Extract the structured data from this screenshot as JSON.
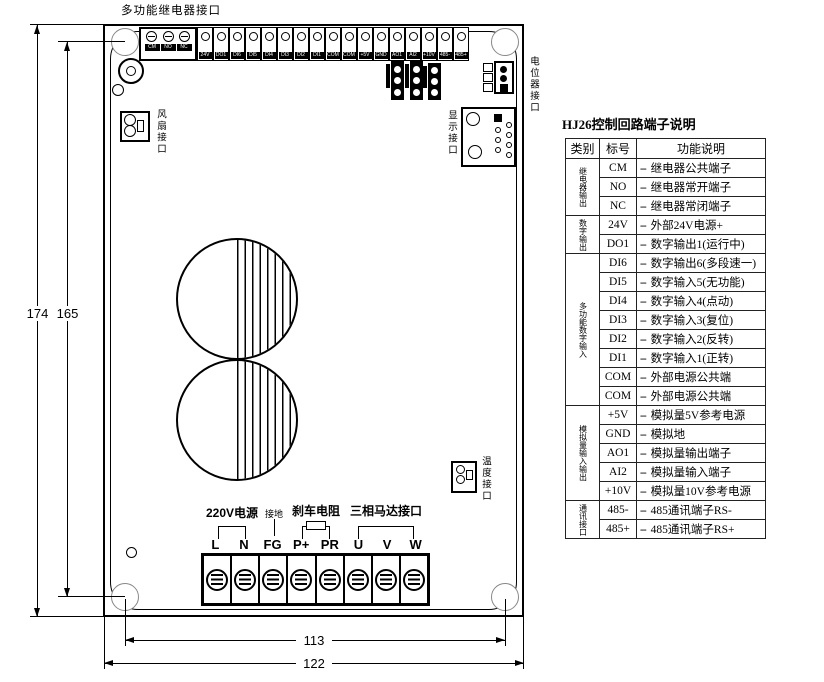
{
  "drawing": {
    "top_label": "多功能继电器接口",
    "relay_terminals": [
      "CM",
      "NO",
      "NC"
    ],
    "control_terminals": [
      "24V",
      "DO1",
      "DI6",
      "DI5",
      "DI4",
      "DI3",
      "DI2",
      "DI1",
      "COM",
      "COM",
      "+5V",
      "GND",
      "AO1",
      "AI2",
      "+10V",
      "485-",
      "485+"
    ],
    "fan_label": "风扇接口",
    "display_label": "显示接口",
    "pot_label": "电位器接口",
    "temp_label": "温度接口",
    "power_terminals": [
      "L",
      "N",
      "FG",
      "P+",
      "PR",
      "U",
      "V",
      "W"
    ],
    "group_220v": "220V电源",
    "group_ground": "接地",
    "group_brake": "刹车电阻",
    "group_motor": "三相马达接口",
    "dim_height_outer": "174",
    "dim_height_holes": "165",
    "dim_width_holes": "113",
    "dim_width_outer": "122"
  },
  "table": {
    "title": "HJ26控制回路端子说明",
    "headers": [
      "类别",
      "标号",
      "功能说明"
    ],
    "dash": "--",
    "groups": [
      {
        "category": "继电器输出",
        "rows": [
          {
            "code": "CM",
            "desc": "继电器公共端子"
          },
          {
            "code": "NO",
            "desc": "继电器常开端子"
          },
          {
            "code": "NC",
            "desc": "继电器常闭端子"
          }
        ]
      },
      {
        "category": "数字输出",
        "rows": [
          {
            "code": "24V",
            "desc": "外部24V电源+"
          },
          {
            "code": "DO1",
            "desc": "数字输出1(运行中)"
          }
        ]
      },
      {
        "category": "多功能数字输入",
        "rows": [
          {
            "code": "DI6",
            "desc": "数字输出6(多段速一)"
          },
          {
            "code": "DI5",
            "desc": "数字输入5(无功能)"
          },
          {
            "code": "DI4",
            "desc": "数字输入4(点动)"
          },
          {
            "code": "DI3",
            "desc": "数字输入3(复位)"
          },
          {
            "code": "DI2",
            "desc": "数字输入2(反转)"
          },
          {
            "code": "DI1",
            "desc": "数字输入1(正转)"
          },
          {
            "code": "COM",
            "desc": "外部电源公共端"
          },
          {
            "code": "COM",
            "desc": "外部电源公共端"
          }
        ]
      },
      {
        "category": "模拟量输入输出",
        "rows": [
          {
            "code": "+5V",
            "desc": "模拟量5V参考电源"
          },
          {
            "code": "GND",
            "desc": "模拟地"
          },
          {
            "code": "AO1",
            "desc": "模拟量输出端子"
          },
          {
            "code": "AI2",
            "desc": "模拟量输入端子"
          },
          {
            "code": "+10V",
            "desc": "模拟量10V参考电源"
          }
        ]
      },
      {
        "category": "通讯接口",
        "rows": [
          {
            "code": "485-",
            "desc": "485通讯端子RS-"
          },
          {
            "code": "485+",
            "desc": "485通讯端子RS+"
          }
        ]
      }
    ]
  }
}
